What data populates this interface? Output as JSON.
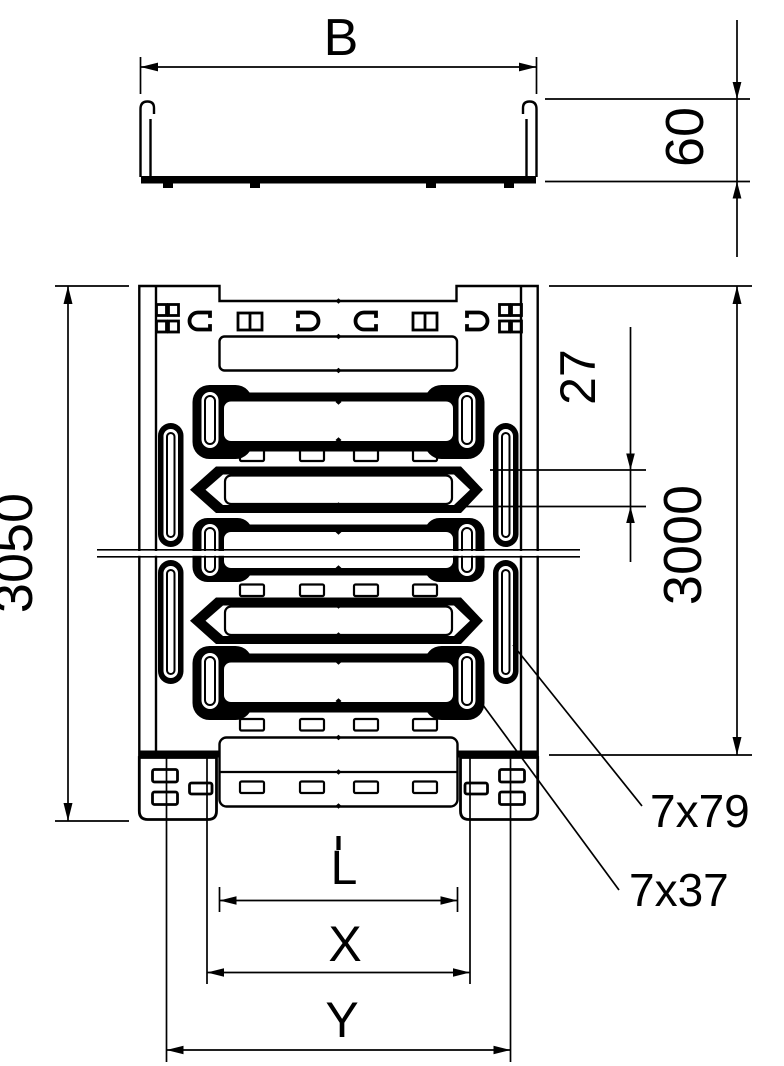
{
  "drawing": {
    "colors": {
      "line": "#000000",
      "background": "#ffffff"
    },
    "cross_section": {
      "width_label": "B",
      "height_label": "60"
    },
    "plan": {
      "total_length_label": "3050",
      "standard_length_label": "3000",
      "slot_pitch_label": "27",
      "side_slot_label": "7x79",
      "base_slot_label": "7x37",
      "coupler": {
        "l_label": "L",
        "x_label": "X",
        "y_label": "Y"
      }
    }
  }
}
